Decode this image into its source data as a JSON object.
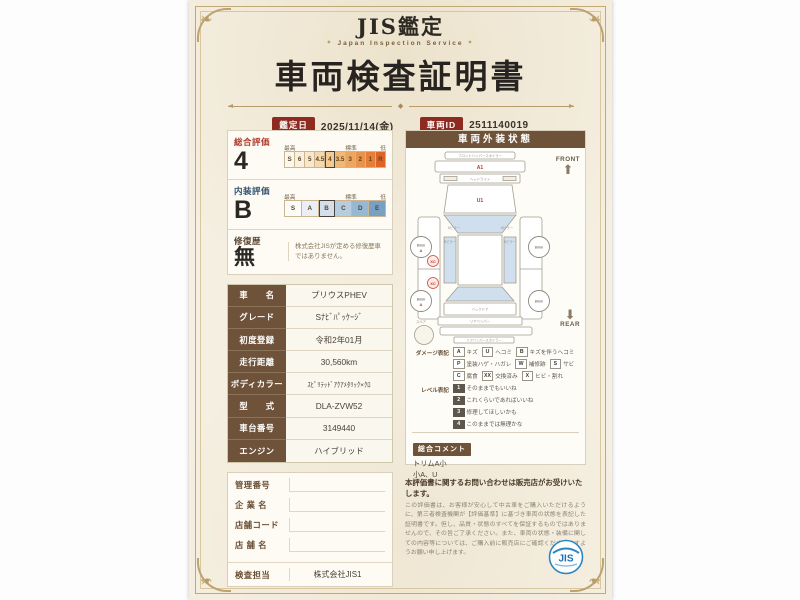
{
  "header": {
    "brand": "JIS鑑定",
    "brand_sub": "Japan Inspection Service",
    "title": "車両検査証明書",
    "date_label": "鑑定日",
    "date_value": "2025/11/14(金)",
    "vehicle_id_label": "車両ID",
    "vehicle_id_value": "2511140019"
  },
  "evaluation": {
    "overall": {
      "label": "総合評価",
      "grade": "4",
      "captions": [
        "最高",
        "標準",
        "低"
      ],
      "scale": [
        "S",
        "6",
        "5",
        "4.5",
        "4",
        "3.5",
        "3",
        "2",
        "1",
        "R"
      ]
    },
    "interior": {
      "label": "内装評価",
      "grade": "B",
      "captions": [
        "最高",
        "標準",
        "低"
      ],
      "scale": [
        "S",
        "A",
        "B",
        "C",
        "D",
        "E"
      ]
    },
    "repair": {
      "label": "修復歴",
      "grade": "無",
      "note": "株式会社JISが定める修復歴車ではありません。"
    }
  },
  "vehicle_info": {
    "rows": [
      {
        "label": "車　　名",
        "value": "プリウスPHEV"
      },
      {
        "label": "グレード",
        "value": "Sﾅﾋﾞﾊﾟｯｹｰｼﾞ"
      },
      {
        "label": "初度登録",
        "value": "令和2年01月"
      },
      {
        "label": "走行距離",
        "value": "30,560km"
      },
      {
        "label": "ボディカラー",
        "value": "ｽﾋﾟﾘﾃｯﾄﾞｱｸｱﾒﾀﾘｯｸ×ｸﾛ"
      },
      {
        "label": "型　　式",
        "value": "DLA-ZVW52"
      },
      {
        "label": "車台番号",
        "value": "3149440"
      },
      {
        "label": "エンジン",
        "value": "ハイブリッド"
      }
    ]
  },
  "office": {
    "rows": [
      {
        "label": "管理番号",
        "value": ""
      },
      {
        "label": "企 業 名",
        "value": ""
      },
      {
        "label": "店舗コード",
        "value": ""
      },
      {
        "label": "店 舗 名",
        "value": ""
      },
      {
        "label": "検査担当",
        "value": "株式会社JIS1"
      }
    ]
  },
  "exterior": {
    "panel_title": "車両外装状態",
    "front_label": "FRONT",
    "rear_label": "REAR",
    "spare_label": "スペア",
    "diagram_labels": {
      "front_spoiler": "フロントバンパースポイラー",
      "headlight": "ヘッドライト",
      "a_pillar_left": "Aピラー",
      "a_pillar_right": "Aピラー",
      "b_pillar_left": "Bピラー",
      "b_pillar_right": "Bピラー",
      "back_door": "バックドア",
      "rear_bumper": "リアバンパー",
      "rear_spoiler": "リアバンパースポイラー"
    },
    "marks": {
      "front_bumper": "A1",
      "hood": "U1",
      "left_door_1": "XC",
      "left_door_2": "XC",
      "tire_lf": "8mm",
      "tire_lf_mark": "A",
      "tire_rf": "8mm",
      "tire_lr": "8mm",
      "tire_lr_mark": "A",
      "tire_rr": "8mm"
    },
    "damage_legend": {
      "label": "ダメージ表記",
      "items": [
        {
          "key": "A",
          "text": "キズ"
        },
        {
          "key": "U",
          "text": "ヘコミ"
        },
        {
          "key": "B",
          "text": "キズを伴うヘコミ"
        },
        {
          "key": "P",
          "text": "塗装ハゲ・ハガレ"
        },
        {
          "key": "W",
          "text": "補修跡"
        },
        {
          "key": "S",
          "text": "サビ"
        },
        {
          "key": "C",
          "text": "腐食"
        },
        {
          "key": "XX",
          "text": "交換済み"
        },
        {
          "key": "X",
          "text": "ヒビ・割れ"
        }
      ]
    },
    "level_legend": {
      "label": "レベル表記",
      "items": [
        {
          "key": "1",
          "text": "そのままでもいいね"
        },
        {
          "key": "2",
          "text": "これくらいであればいいね"
        },
        {
          "key": "3",
          "text": "修理してほしいかも"
        },
        {
          "key": "4",
          "text": "このままでは無理かな"
        }
      ]
    },
    "comment": {
      "label": "総合コメント",
      "line1": "トリムA小",
      "line2": "小A、U"
    }
  },
  "disclaimer": {
    "headline": "本評価書に関するお問い合わせは販売店がお受けいたします。",
    "body": "この評価書は、お客様が安心して中古車をご購入いただけるように、第三者検査機関が【評価基準】に基づき車両の状態を表記した証明書です。但し、品質・状態のすべてを保証するものではありませんので、その旨ご了承ください。また、車両の状態・装備に関しての内容等については、ご購入前に販売店にご確認くださいますようお願い申し上げます。"
  },
  "logo": {
    "text": "JIS"
  }
}
